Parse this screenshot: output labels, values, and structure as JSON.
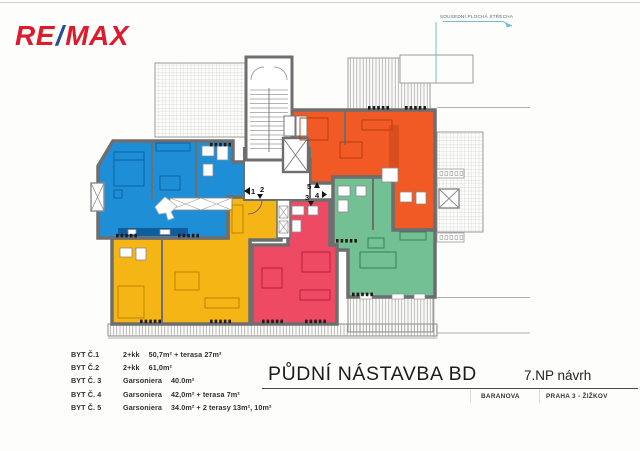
{
  "logo": {
    "re": "RE",
    "slash": "/",
    "max": "MAX"
  },
  "roof_note": {
    "label": "SOUSEDNÍ PLOCHÁ STŘECHA"
  },
  "markers": {
    "m1": "1",
    "m2": "2",
    "m3": "3",
    "m4": "4",
    "m5": "5"
  },
  "legend": {
    "rows": [
      {
        "label": "BYT Č.1",
        "type": "2+kk",
        "area": "50,7m² + terasa 27m²"
      },
      {
        "label": "BYT Č.2",
        "type": "2+kk",
        "area": "61,0m²"
      },
      {
        "label": "BYT Č. 3",
        "type": "Garsoniera",
        "area": "40.0m²"
      },
      {
        "label": "BYT Č. 4",
        "type": "Garsoniera",
        "area": "42,0m² + terasa  7m²"
      },
      {
        "label": "BYT Č. 5",
        "type": "Garsoniera",
        "area": "34.0m² + 2 terasy 13m², 10m²"
      }
    ]
  },
  "title_block": {
    "title": "PŮDNÍ NÁSTAVBA BD",
    "variant": "7.NP návrh",
    "street": "BARANOVA",
    "district": "PRAHA 3 - ŽIŽKOV"
  },
  "colors": {
    "brand_red": "#dc1c2d",
    "brand_blue": "#1f4ea1",
    "unit_blue": "#1e8ed7",
    "unit_orange": "#f15a24",
    "unit_yellow": "#f5b515",
    "unit_pink": "#ee4a63",
    "unit_green": "#72c094",
    "wall": "#6e6e6e",
    "guide": "#72bfcb"
  }
}
